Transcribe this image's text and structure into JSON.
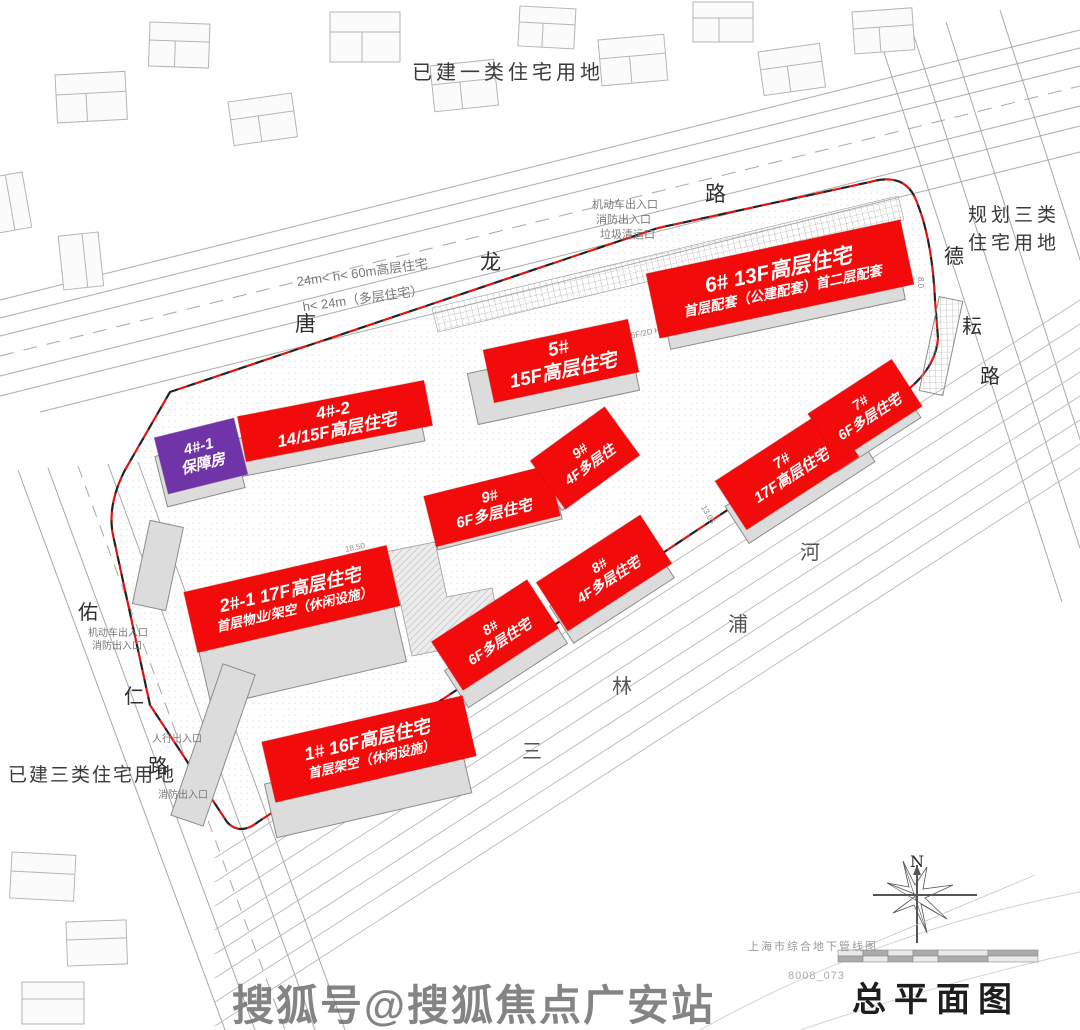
{
  "title_block": {
    "drawing_title": "总平面图",
    "source_note": "上海市综合地下管线图",
    "sheet_no": "8008_073",
    "compass_label": "N"
  },
  "watermark": {
    "text": "搜狐号@搜狐焦点广安站"
  },
  "land_use_labels": {
    "top": "已建一类住宅用地",
    "right_line1": "规划三类",
    "right_line2": "住宅用地",
    "bottom_left": "已建三类住宅用地"
  },
  "roads": {
    "tanglong": {
      "chars": [
        "唐",
        "龙",
        "路"
      ]
    },
    "deyun": {
      "chars": [
        "德",
        "耘",
        "路"
      ]
    },
    "youren": {
      "chars": [
        "佑",
        "仁",
        "路"
      ]
    }
  },
  "river": {
    "chars": [
      "三",
      "林",
      "浦",
      "河"
    ]
  },
  "height_notes": {
    "line1": "24m< h< 60m高层住宅",
    "line2": "h< 24m（多层住宅）"
  },
  "entrances": {
    "top_line1": "机动车出入口",
    "top_line2": "消防出入口",
    "top_line3": "垃圾清运口",
    "left_line1": "机动车出入口",
    "left_line2": "消防出入口",
    "pedestrian": "人行出入口",
    "fire": "消防出入口"
  },
  "buildings": {
    "b4_1": {
      "line1": "4#-1",
      "line2": "保障房",
      "color": "#6f35a8"
    },
    "b4_2": {
      "line1": "4#-2",
      "line2": "14/15F高层住宅",
      "color": "#f30b0b"
    },
    "b5": {
      "line1": "5#",
      "line2": "15F高层住宅",
      "color": "#f30b0b"
    },
    "b6": {
      "line1": "6#  13F高层住宅",
      "line2": "首层配套（公建配套）首二层配套",
      "color": "#f30b0b"
    },
    "b9_6f": {
      "line1": "9#",
      "line2": "6F多层住宅",
      "color": "#f30b0b"
    },
    "b9_4f": {
      "line1": "9#",
      "line2": "4F多层住",
      "color": "#f30b0b"
    },
    "b7_17f": {
      "line1": "7#",
      "line2": "17F高层住宅",
      "color": "#f30b0b"
    },
    "b7_6f": {
      "line1": "7#",
      "line2": "6F多层住宅",
      "color": "#f30b0b"
    },
    "b8_6f": {
      "line1": "8#",
      "line2": "6F多层住宅",
      "color": "#f30b0b"
    },
    "b8_4f": {
      "line1": "8#",
      "line2": "4F多层住宅",
      "color": "#f30b0b"
    },
    "b2_1": {
      "line1": "2#-1 17F高层住宅",
      "line2": "首层物业/架空（休闲设施）",
      "color": "#f30b0b"
    },
    "b1": {
      "line1": "1#  16F高层住宅",
      "line2": "首层架空（休闲设施）",
      "color": "#f30b0b"
    }
  },
  "small_dims": {
    "d5f": "15F/2D H=47.2M",
    "d1": "12.00",
    "d2": "8.0",
    "d3": "18.50",
    "d4": "56.00",
    "d5": "13.05",
    "d6": "33.80"
  },
  "colors": {
    "label_red": "#f30b0b",
    "label_purple": "#6f35a8",
    "boundary_red": "#e8100c",
    "line_gray": "#9a9a9a"
  }
}
